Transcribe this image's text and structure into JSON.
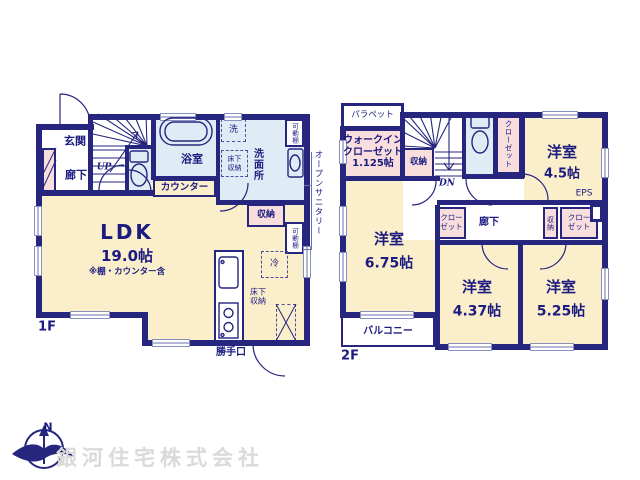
{
  "floor1": {
    "floor_label": "1F",
    "entrance": "玄関",
    "hallway": "廊下",
    "stairs_up": "UP",
    "bathroom": "浴室",
    "counter": "カウンター",
    "washer": "洗",
    "underfloor_storage_wash": "床下収納",
    "washroom": "洗面所",
    "movable_shelf_top": "可動棚",
    "open_sanitary": "オープンサニタリー",
    "storage": "収納",
    "movable_shelf_side": "可動棚",
    "refrigerator": "冷",
    "underfloor_storage_kitchen": "床下収納",
    "ldk_name": "LDK",
    "ldk_size": "19.0帖",
    "ldk_note": "※棚・カウンター含",
    "back_door": "勝手口"
  },
  "floor2": {
    "floor_label": "2F",
    "parapet": "パラペット",
    "walk_in_closet": "ウォークイン\nクローゼット\n1.125帖",
    "storage_stairs": "収納",
    "stairs_down": "DN",
    "closet_north": "クローゼット",
    "room_ne_name": "洋室",
    "room_ne_size": "4.5帖",
    "eps": "EPS",
    "hallway": "廊下",
    "closet_mid": "クローゼット",
    "storage_hall": "収納",
    "closet_east": "クローゼット",
    "room_w_name": "洋室",
    "room_w_size": "6.75帖",
    "room_s_name": "洋室",
    "room_s_size": "4.37帖",
    "room_se_name": "洋室",
    "room_se_size": "5.25帖",
    "balcony": "バルコニー"
  },
  "footer": {
    "compass_north": "N",
    "company": "銀河住宅株式会社"
  }
}
